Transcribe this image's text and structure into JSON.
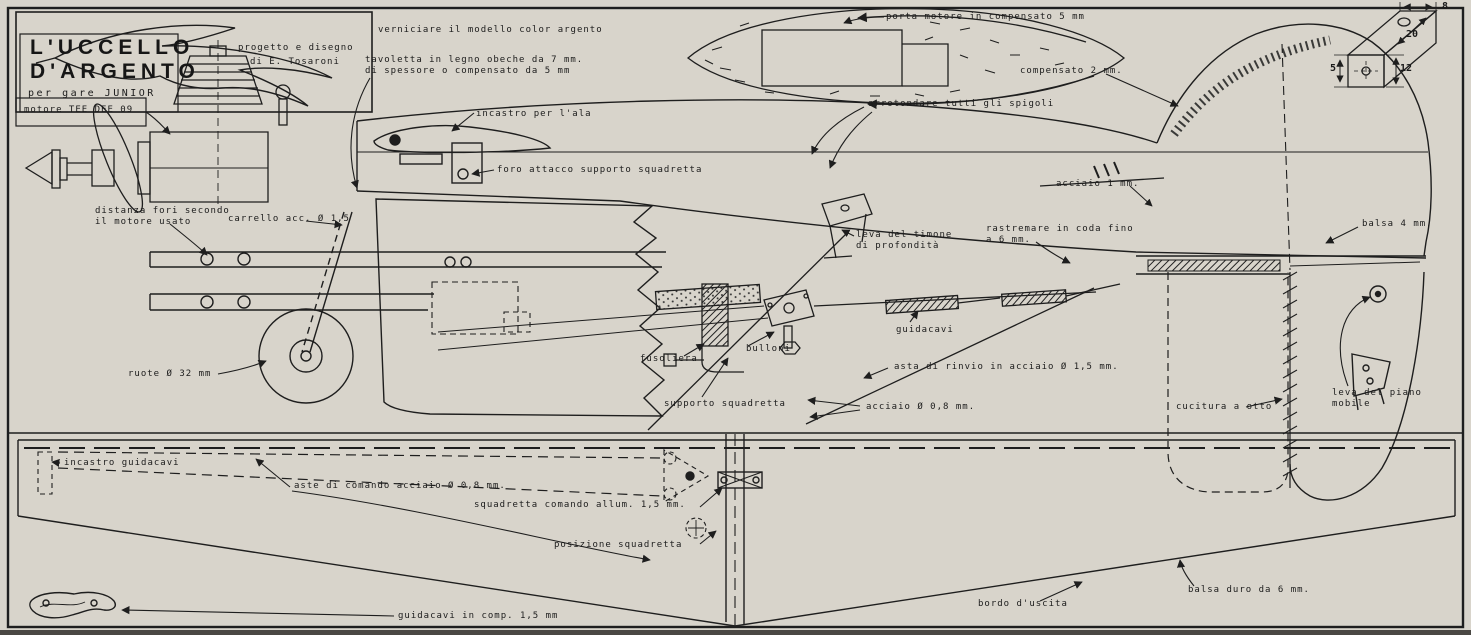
{
  "colors": {
    "paper": "#d8d4cb",
    "ink": "#1e1e1e"
  },
  "title_block": {
    "title_line1": "L'UCCELLO",
    "title_line2": "D'ARGENTO",
    "subtitle": "per gare  JUNIOR",
    "credit_line1": "progetto e disegno",
    "credit_line2": "di E. Tosaroni",
    "motor": "motore TEE DEE 09"
  },
  "detail_dimensions": {
    "d8": "8",
    "d20": "20",
    "d12": "12",
    "d5": "5"
  },
  "annotations": [
    {
      "id": "verniciare",
      "text": "verniciare il modello color argento"
    },
    {
      "id": "tavoletta",
      "text": "tavoletta in legno obeche da 7 mm.\ndi spessore o compensato da 5 mm"
    },
    {
      "id": "incastro-ala",
      "text": "incastro per l'ala"
    },
    {
      "id": "foro-attacco",
      "text": "foro attacco supporto squadretta"
    },
    {
      "id": "porta-motore",
      "text": "porta motore in compensato 5 mm"
    },
    {
      "id": "compensato-2",
      "text": "compensato 2 mm."
    },
    {
      "id": "arrotondare",
      "text": "arrotondare tutti gli spigoli"
    },
    {
      "id": "acciaio-1",
      "text": "acciaio 1 mm."
    },
    {
      "id": "balsa-4",
      "text": "balsa 4 mm."
    },
    {
      "id": "distanza-fori",
      "text": "distanza fori secondo\nil motore usato"
    },
    {
      "id": "carrello",
      "text": "carrello acc. Ø 1,5"
    },
    {
      "id": "leva-timone",
      "text": "leva del timone\ndi profondità"
    },
    {
      "id": "rastremare",
      "text": "rastremare in coda fino\na 6 mm."
    },
    {
      "id": "ruote",
      "text": "ruote Ø 32 mm"
    },
    {
      "id": "guidacavi-mid",
      "text": "guidacavi"
    },
    {
      "id": "bulloni",
      "text": "bulloni"
    },
    {
      "id": "fusoliera",
      "text": "fusoliera"
    },
    {
      "id": "supporto-squadretta",
      "text": "supporto squadretta"
    },
    {
      "id": "asta-rinvio",
      "text": "asta di rinvio in acciaio Ø 1,5 mm."
    },
    {
      "id": "acciaio-08",
      "text": "acciaio Ø 0,8 mm."
    },
    {
      "id": "cucitura",
      "text": "cucitura a otto"
    },
    {
      "id": "leva-piano",
      "text": "leva del piano\nmobile"
    },
    {
      "id": "incastro-guidacavi",
      "text": "incastro guidacavi"
    },
    {
      "id": "aste-comando",
      "text": "aste di comando acciaio Ø 0,8 mm."
    },
    {
      "id": "squadretta-comando",
      "text": "squadretta comando allum. 1,5 mm."
    },
    {
      "id": "posizione-squadretta",
      "text": "posizione squadretta"
    },
    {
      "id": "bordo-uscita",
      "text": "bordo d'uscita"
    },
    {
      "id": "balsa-duro",
      "text": "balsa duro da 6 mm."
    },
    {
      "id": "guidacavi-comp",
      "text": "guidacavi in comp. 1,5 mm"
    }
  ]
}
